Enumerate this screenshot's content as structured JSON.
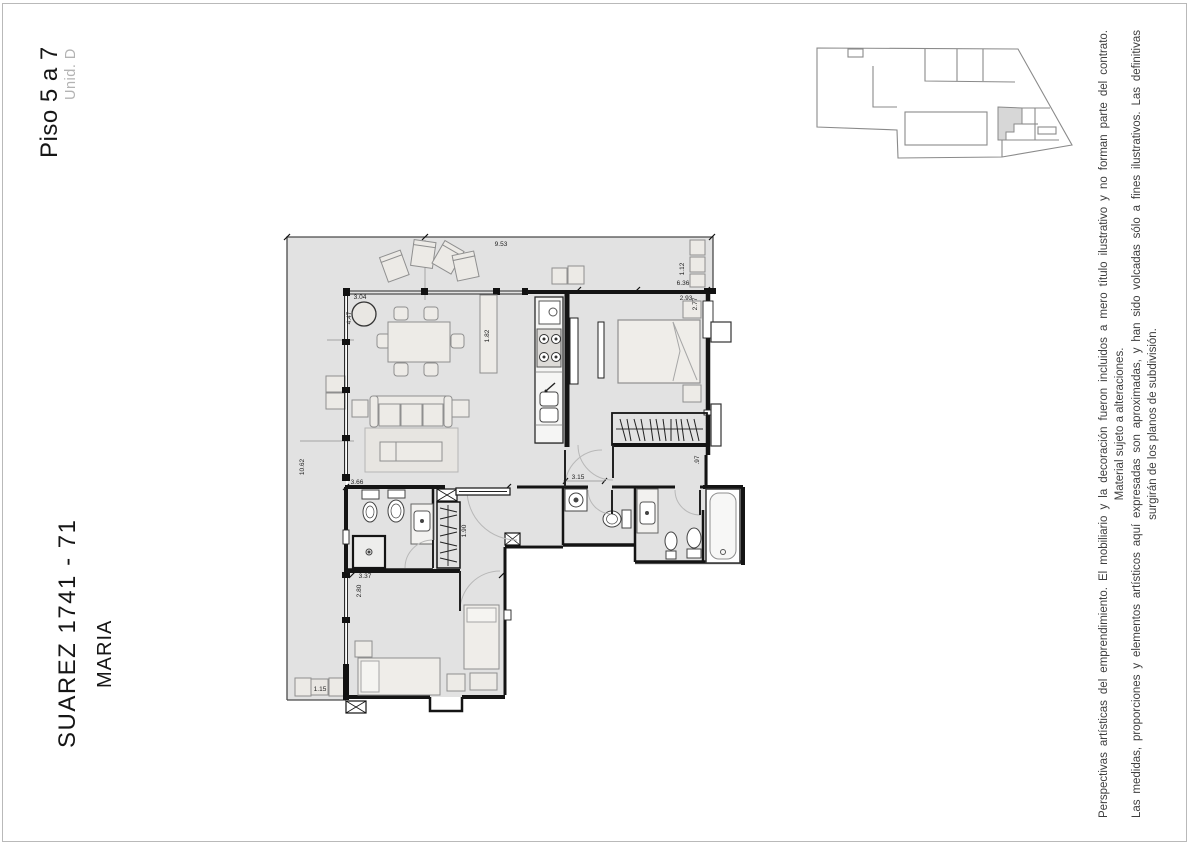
{
  "header": {
    "floor_label": "Piso 5 a 7",
    "unit_label": "Unid. D"
  },
  "footer": {
    "project_name": "SUAREZ 1741 - 71",
    "project_subname": "MARIA"
  },
  "disclaimer": {
    "line1": "Perspectivas artísticas del emprendimiento. El mobiliario y la decoración fueron incluidos a mero título ilustrativo y no forman parte del contrato.",
    "line2": "Material sujeto a alteraciones.",
    "line3": "Las medidas, proporciones y elementos artísticos aquí expresadas son aproximadas, y han sido volcadas sólo a fines ilustrativos. Las definitivas",
    "line4": "surgirán de los planos de subdivisión."
  },
  "floorplan": {
    "dims": {
      "terrace_width": "9.53",
      "living_width": "3.04",
      "living_depth": "4.47",
      "sideboard_length": "1.82",
      "balcony_right_depth": "1.12",
      "balcony_right_length": "6.36",
      "bedroom1_width": "2.93",
      "bedroom1_depth": "2.77",
      "terrace_left_length": "10.62",
      "bath_zone_width": "3.66",
      "closet_length": "1.90",
      "hall_width": "3.15",
      "wall_offset": ".97",
      "bedroom2_width": "3.37",
      "bedroom2_depth": "2.80",
      "planter_width": "1.15"
    }
  },
  "colors": {
    "floor_fill": "#e2e2e2",
    "wall": "#141414",
    "furniture_fill": "#edebe7",
    "furniture_stroke": "#8f8f8f",
    "parapet": "#4a4a4a",
    "keyplan_stroke": "#8a8a8a",
    "keyplan_highlight": "#d7d7d7",
    "muted_text": "#b3b3b3",
    "dimension_text": "#222222"
  }
}
